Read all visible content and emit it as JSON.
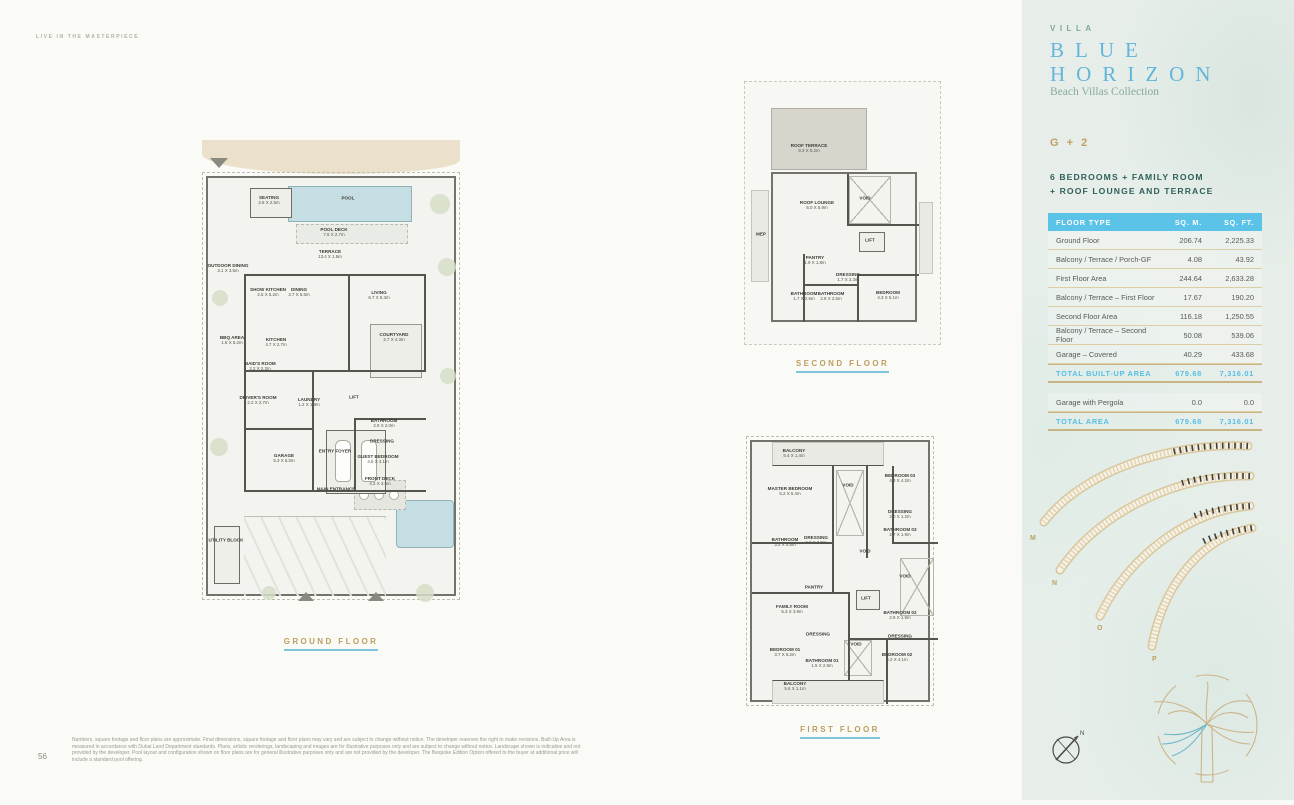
{
  "page": {
    "eyebrow": "LIVE IN THE MASTERPIECE",
    "page_number": "56",
    "disclaimer": "Numbers, square footage and floor plans are approximate. Final dimensions, square footage and floor plans may vary and are subject to change without notice. The developer reserves the right to make revisions. Built-Up Area is measured in accordance with Dubai Land Department standards. Plans, artistic renderings, landscaping and images are for illustrative purposes only and are subject to change without notice. Landscape shown is indicative and not provided by the developer. Pool layout and configuration shown on floor plans are for general illustrative purposes only and are not provided by the developer. The Bespoke Edition Option offered to the buyer at additional price will include a standard pool offering."
  },
  "plans": {
    "ground": {
      "label": "GROUND FLOOR",
      "rooms": [
        {
          "name": "SEATING",
          "dims": "2.8 X 2.5m"
        },
        {
          "name": "POOL",
          "dims": ""
        },
        {
          "name": "POOL DECK",
          "dims": "7.6 X 2.7m"
        },
        {
          "name": "TERRACE",
          "dims": "13.4 X 1.5m"
        },
        {
          "name": "OUTDOOR DINING",
          "dims": "3.1 X 3.5m"
        },
        {
          "name": "SHOW KITCHEN",
          "dims": "2.5 X 5.2m"
        },
        {
          "name": "DINING",
          "dims": "3.7 X 5.5m"
        },
        {
          "name": "LIVING",
          "dims": "6.7 X 5.3m"
        },
        {
          "name": "BBQ AREA",
          "dims": "1.8 X 5.2m"
        },
        {
          "name": "KITCHEN",
          "dims": "4.7 X 2.7m"
        },
        {
          "name": "COURTYARD",
          "dims": "2.7 X 4.3m"
        },
        {
          "name": "MAID'S ROOM",
          "dims": "2.2 X 2.3m"
        },
        {
          "name": "DRIVER'S ROOM",
          "dims": "2.2 X 2.7m"
        },
        {
          "name": "LAUNDRY",
          "dims": "1.2 X 1.8m"
        },
        {
          "name": "LIFT",
          "dims": ""
        },
        {
          "name": "BATHROOM",
          "dims": "2.9 X 2.0m"
        },
        {
          "name": "DRESSING",
          "dims": ""
        },
        {
          "name": "GUEST BEDROOM",
          "dims": "4.5 X 4.1m"
        },
        {
          "name": "GARAGE",
          "dims": "5.3 X 5.0m"
        },
        {
          "name": "ENTRY FOYER",
          "dims": ""
        },
        {
          "name": "MAIN ENTRANCE",
          "dims": ""
        },
        {
          "name": "FRONT DECK",
          "dims": "4.2 X 3.5m"
        },
        {
          "name": "UTILITY BLOCK",
          "dims": ""
        }
      ]
    },
    "second": {
      "label": "SECOND FLOOR",
      "rooms": [
        {
          "name": "ROOF TERRACE",
          "dims": "9.3 X 5.2m"
        },
        {
          "name": "ROOF LOUNGE",
          "dims": "5.0 X 5.9m"
        },
        {
          "name": "VOID",
          "dims": ""
        },
        {
          "name": "MEP",
          "dims": ""
        },
        {
          "name": "LIFT",
          "dims": ""
        },
        {
          "name": "PANTRY",
          "dims": "1.9 X 1.8m"
        },
        {
          "name": "DRESSING",
          "dims": "1.7 X 2.3m"
        },
        {
          "name": "BATHROOM",
          "dims": "1.7 X 2.6m"
        },
        {
          "name": "BATHROOM",
          "dims": "2.8 X 2.5m"
        },
        {
          "name": "BEDROOM",
          "dims": "4.3 X 5.1m"
        }
      ]
    },
    "first": {
      "label": "FIRST FLOOR",
      "rooms": [
        {
          "name": "BALCONY",
          "dims": "5.4 X 1.4m"
        },
        {
          "name": "MASTER BEDROOM",
          "dims": "5.2 X 5.4m"
        },
        {
          "name": "VOID",
          "dims": ""
        },
        {
          "name": "BEDROOM 03",
          "dims": "4.3 X 4.2m"
        },
        {
          "name": "DRESSING",
          "dims": "2.0 X 1.2m"
        },
        {
          "name": "BATHROOM 03",
          "dims": "2.7 X 1.9m"
        },
        {
          "name": "BATHROOM",
          "dims": "3.4 X 4.6m"
        },
        {
          "name": "DRESSING",
          "dims": "2.0 X 3.9m"
        },
        {
          "name": "VOID",
          "dims": ""
        },
        {
          "name": "VOID",
          "dims": ""
        },
        {
          "name": "LIFT",
          "dims": ""
        },
        {
          "name": "PANTRY",
          "dims": ""
        },
        {
          "name": "FAMILY ROOM",
          "dims": "5.3 X 3.9m"
        },
        {
          "name": "BATHROOM 02",
          "dims": "2.9 X 1.9m"
        },
        {
          "name": "DRESSING",
          "dims": ""
        },
        {
          "name": "BEDROOM 01",
          "dims": "3.7 X 5.2m"
        },
        {
          "name": "DRESSING",
          "dims": ""
        },
        {
          "name": "BATHROOM 01",
          "dims": "1.5 X 2.9m"
        },
        {
          "name": "VOID",
          "dims": ""
        },
        {
          "name": "BEDROOM 02",
          "dims": "4.2 X 4.1m"
        },
        {
          "name": "BALCONY",
          "dims": "5.6 X 1.1m"
        }
      ]
    }
  },
  "sidebar": {
    "villa_label": "VILLA",
    "title_line1": "BLUE",
    "title_line2": "HORIZON",
    "subtitle": "Beach Villas Collection",
    "config": "G + 2",
    "features_line1": "6 BEDROOMS + FAMILY ROOM",
    "features_line2": "+ ROOF LOUNGE AND TERRACE",
    "table": {
      "headers": [
        "FLOOR TYPE",
        "SQ. M.",
        "SQ. FT."
      ],
      "rows": [
        {
          "label": "Ground Floor",
          "sqm": "206.74",
          "sqft": "2,225.33",
          "type": "normal"
        },
        {
          "label": "Balcony / Terrace / Porch-GF",
          "sqm": "4.08",
          "sqft": "43.92",
          "type": "normal"
        },
        {
          "label": "First Floor Area",
          "sqm": "244.64",
          "sqft": "2,633.28",
          "type": "normal"
        },
        {
          "label": "Balcony / Terrace – First Floor",
          "sqm": "17.67",
          "sqft": "190.20",
          "type": "normal"
        },
        {
          "label": "Second Floor Area",
          "sqm": "116.18",
          "sqft": "1,250.55",
          "type": "normal"
        },
        {
          "label": "Balcony / Terrace – Second Floor",
          "sqm": "50.08",
          "sqft": "539.06",
          "type": "normal"
        },
        {
          "label": "Garage – Covered",
          "sqm": "40.29",
          "sqft": "433.68",
          "type": "normal"
        },
        {
          "label": "TOTAL BUILT-UP AREA",
          "sqm": "679.68",
          "sqft": "7,316.01",
          "type": "total"
        },
        {
          "label": "",
          "sqm": "",
          "sqft": "",
          "type": "spacer"
        },
        {
          "label": "Garage with Pergola",
          "sqm": "0.0",
          "sqft": "0.0",
          "type": "normal"
        },
        {
          "label": "TOTAL AREA",
          "sqm": "679.68",
          "sqft": "7,316.01",
          "type": "total"
        }
      ]
    },
    "map": {
      "frond_labels": [
        "M",
        "N",
        "O",
        "P"
      ],
      "compass_label": "N"
    }
  },
  "colors": {
    "accent_gold": "#BE9F63",
    "title_blue": "#63B6DB",
    "table_header_blue": "#5CC3E8",
    "teal": "#7FA99C",
    "dark_teal": "#2F5F59",
    "pool_blue": "#C5DEE3",
    "sidebar_bg": "#E7EEE9"
  }
}
